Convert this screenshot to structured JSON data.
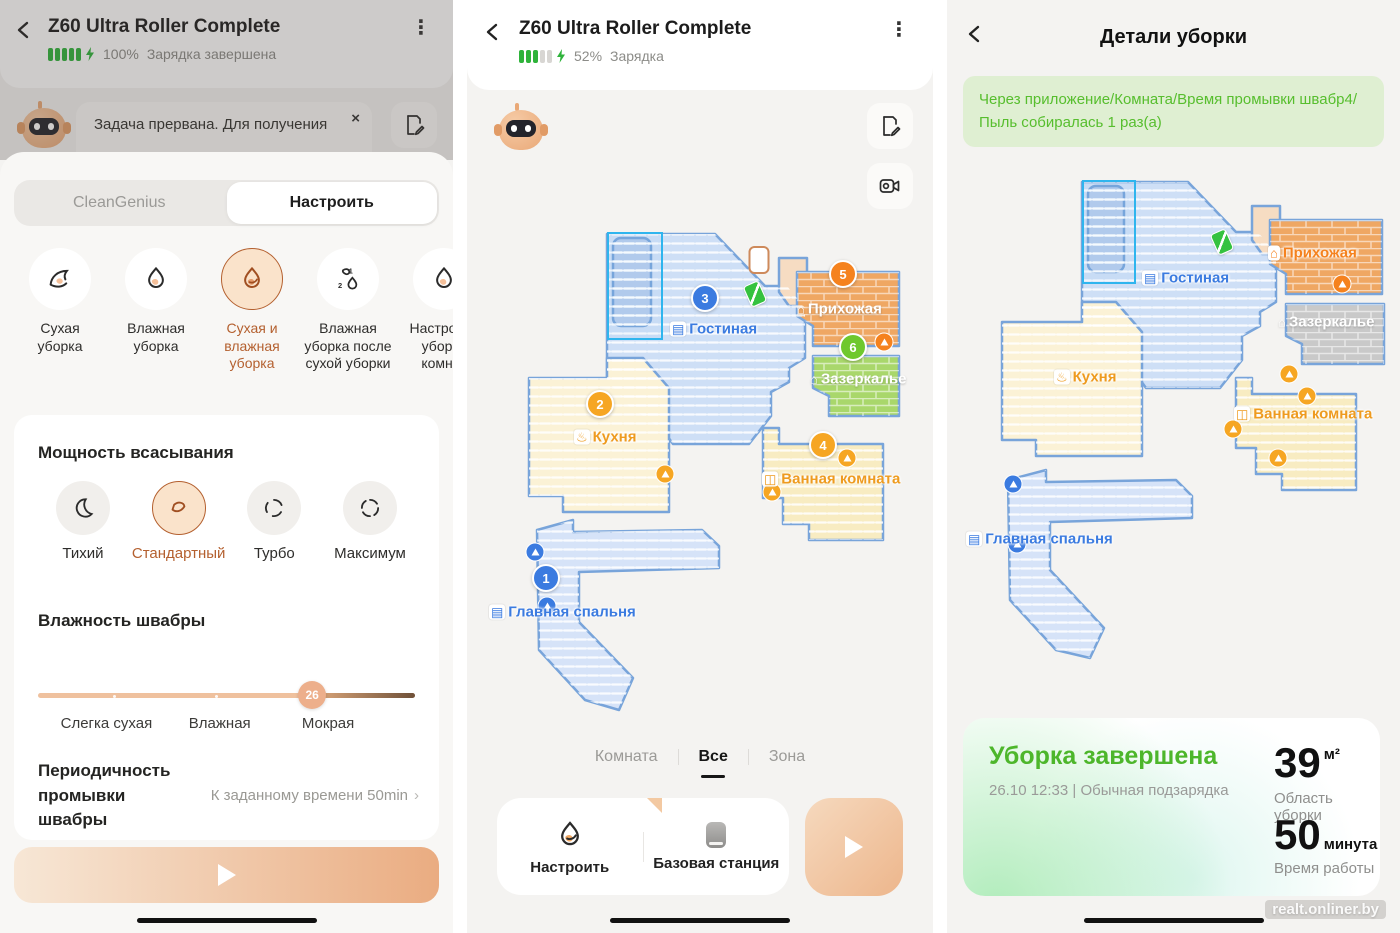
{
  "device": {
    "title": "Z60 Ultra Roller Complete"
  },
  "panel1": {
    "battery_percent": "100%",
    "battery_status": "Зарядка завершена",
    "toast": {
      "text": "Задача прервана. Для получения",
      "close": "×"
    },
    "tabs": [
      {
        "label": "CleanGenius"
      },
      {
        "label": "Настроить"
      }
    ],
    "modes": [
      {
        "label": "Сухая уборка"
      },
      {
        "label": "Влажная уборка"
      },
      {
        "label": "Сухая и влажная уборка"
      },
      {
        "label": "Влажная уборка после сухой уборки"
      },
      {
        "label": "Настройка уборки комнат"
      }
    ],
    "suction_title": "Мощность всасывания",
    "suction": [
      {
        "label": "Тихий"
      },
      {
        "label": "Стандартный"
      },
      {
        "label": "Турбо"
      },
      {
        "label": "Максимум"
      }
    ],
    "humidity_title": "Влажность швабры",
    "humidity_value": "26",
    "humidity_labels": [
      {
        "label": "Слегка сухая"
      },
      {
        "label": "Влажная"
      },
      {
        "label": "Мокрая"
      }
    ],
    "wash_label": "Периодичность промывки швабры",
    "wash_value": "К заданному времени 50min",
    "chevron_right": "›"
  },
  "panel2": {
    "battery_percent": "52%",
    "battery_status": "Зарядка",
    "tabs": [
      {
        "label": "Комната"
      },
      {
        "label": "Все"
      },
      {
        "label": "Зона"
      }
    ],
    "actions": [
      {
        "label": "Настроить"
      },
      {
        "label": "Базовая станция"
      }
    ]
  },
  "panel3": {
    "title": "Детали уборки",
    "banner": "Через приложение/Комната/Время промывки швабр4/Пыль собиралась 1 раз(а)",
    "result_title": "Уборка завершена",
    "result_subtitle": "26.10  12:33 | Обычная подзарядка",
    "area_value": "39",
    "area_unit": "м²",
    "area_label": "Область уборки",
    "time_value": "50",
    "time_unit": "минута",
    "time_label": "Время работы",
    "watermark": "realt.onliner.by"
  },
  "colors": {
    "accent": "#B4602F",
    "green": "#4DB62B",
    "badge_blue": "#3B7BE0",
    "badge_yellow": "#F6A623",
    "badge_orange": "#F5821E",
    "badge_green": "#6FC82D"
  },
  "maps": {
    "map1": {
      "labels": [
        {
          "text": "Гостиная",
          "c": "#3B7BE0",
          "x": 203,
          "y": 99,
          "ic": "▤",
          "icb": true
        },
        {
          "text": "Прихожая",
          "c": "#FFFFFF",
          "x": 330,
          "y": 79,
          "ic": "⌂",
          "icb": false
        },
        {
          "text": "Зазеркалье",
          "c": "#FFFFFF",
          "x": 343,
          "y": 149,
          "ic": "⌂",
          "icb": false
        },
        {
          "text": "Кухня",
          "c": "#EE9B1F",
          "x": 107,
          "y": 207,
          "ic": "♨",
          "icb": true
        },
        {
          "text": "Ванная комната",
          "c": "#EE9B1F",
          "x": 295,
          "y": 249,
          "ic": "◫",
          "icb": true
        },
        {
          "text": "Главная спальня",
          "c": "#3B7BE0",
          "x": 22,
          "y": 382,
          "ic": "▤",
          "icb": true
        }
      ],
      "badges": [
        {
          "n": "3",
          "c": "#3B7BE0",
          "x": 238,
          "y": 68
        },
        {
          "n": "5",
          "c": "#F5821E",
          "x": 376,
          "y": 44
        },
        {
          "n": "6",
          "c": "#6FC82D",
          "x": 386,
          "y": 117
        },
        {
          "n": "2",
          "c": "#F6A623",
          "x": 133,
          "y": 174
        },
        {
          "n": "4",
          "c": "#F6A623",
          "x": 356,
          "y": 215
        },
        {
          "n": "1",
          "c": "#3B7BE0",
          "x": 79,
          "y": 348
        }
      ],
      "cones": [
        {
          "c": "#F6A623",
          "x": 198,
          "y": 244
        },
        {
          "c": "#F5821E",
          "x": 417,
          "y": 112
        },
        {
          "c": "#F6A623",
          "x": 380,
          "y": 228
        },
        {
          "c": "#F6A623",
          "x": 305,
          "y": 262
        },
        {
          "c": "#3B7BE0",
          "x": 68,
          "y": 322
        },
        {
          "c": "#3B7BE0",
          "x": 80,
          "y": 376
        }
      ],
      "robot": {
        "x": 288,
        "y": 64
      },
      "dock": {
        "x": 292,
        "y": 30
      },
      "selection": {
        "x": 140,
        "y": 2,
        "w": 52,
        "h": 104
      }
    },
    "map2": {
      "labels": [
        {
          "text": "Гостиная",
          "c": "#3B7BE0",
          "x": 206,
          "y": 128,
          "ic": "▤",
          "icb": true
        },
        {
          "text": "Прихожая",
          "c": "#F5821E",
          "x": 332,
          "y": 103,
          "ic": "⌂",
          "icb": true
        },
        {
          "text": "Зазеркалье",
          "c": "#FFFFFF",
          "x": 342,
          "y": 172,
          "ic": "⌂",
          "icb": false
        },
        {
          "text": "Кухня",
          "c": "#EE9B1F",
          "x": 118,
          "y": 227,
          "ic": "♨",
          "icb": true
        },
        {
          "text": "Ванная комната",
          "c": "#EE9B1F",
          "x": 298,
          "y": 264,
          "ic": "◫",
          "icb": true
        },
        {
          "text": "Главная спальня",
          "c": "#3B7BE0",
          "x": 30,
          "y": 389,
          "ic": "▤",
          "icb": true
        }
      ],
      "badges": [],
      "cones": [
        {
          "c": "#F5821E",
          "x": 406,
          "y": 134
        },
        {
          "c": "#F6A623",
          "x": 353,
          "y": 224
        },
        {
          "c": "#F6A623",
          "x": 371,
          "y": 246
        },
        {
          "c": "#F6A623",
          "x": 297,
          "y": 279
        },
        {
          "c": "#F6A623",
          "x": 342,
          "y": 308
        },
        {
          "c": "#3B7BE0",
          "x": 77,
          "y": 334
        },
        {
          "c": "#3B7BE0",
          "x": 81,
          "y": 394
        }
      ],
      "robot": {
        "x": 286,
        "y": 92
      },
      "selection": {
        "x": 146,
        "y": 30,
        "w": 50,
        "h": 100
      }
    }
  }
}
